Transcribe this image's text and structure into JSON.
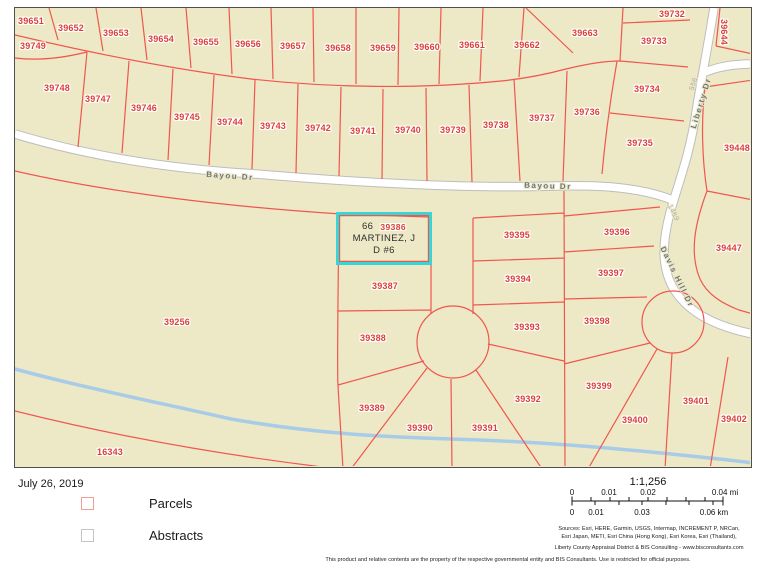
{
  "map": {
    "selected_parcel": {
      "account": "39386",
      "lines": [
        "66",
        "MARTINEZ, J",
        "D #6"
      ]
    },
    "parcel_labels": [
      {
        "t": "39651",
        "x": 31,
        "y": 21
      },
      {
        "t": "39652",
        "x": 71,
        "y": 28
      },
      {
        "t": "39653",
        "x": 116,
        "y": 33
      },
      {
        "t": "39654",
        "x": 161,
        "y": 39
      },
      {
        "t": "39655",
        "x": 206,
        "y": 42
      },
      {
        "t": "39656",
        "x": 248,
        "y": 44
      },
      {
        "t": "39657",
        "x": 293,
        "y": 46
      },
      {
        "t": "39658",
        "x": 338,
        "y": 48
      },
      {
        "t": "39659",
        "x": 383,
        "y": 48
      },
      {
        "t": "39660",
        "x": 427,
        "y": 47
      },
      {
        "t": "39661",
        "x": 472,
        "y": 45
      },
      {
        "t": "39662",
        "x": 527,
        "y": 45
      },
      {
        "t": "39663",
        "x": 585,
        "y": 33
      },
      {
        "t": "39732",
        "x": 672,
        "y": 14
      },
      {
        "t": "39733",
        "x": 654,
        "y": 41
      },
      {
        "t": "39644",
        "x": 724,
        "y": 32,
        "rot": 90
      },
      {
        "t": "39734",
        "x": 647,
        "y": 89
      },
      {
        "t": "39735",
        "x": 640,
        "y": 143
      },
      {
        "t": "39736",
        "x": 587,
        "y": 112
      },
      {
        "t": "39737",
        "x": 542,
        "y": 118
      },
      {
        "t": "39738",
        "x": 496,
        "y": 125
      },
      {
        "t": "39739",
        "x": 453,
        "y": 130
      },
      {
        "t": "39740",
        "x": 408,
        "y": 130
      },
      {
        "t": "39741",
        "x": 363,
        "y": 131
      },
      {
        "t": "39742",
        "x": 318,
        "y": 128
      },
      {
        "t": "39743",
        "x": 273,
        "y": 126
      },
      {
        "t": "39744",
        "x": 230,
        "y": 122
      },
      {
        "t": "39745",
        "x": 187,
        "y": 117
      },
      {
        "t": "39746",
        "x": 144,
        "y": 108
      },
      {
        "t": "39747",
        "x": 98,
        "y": 99
      },
      {
        "t": "39748",
        "x": 57,
        "y": 88
      },
      {
        "t": "39749",
        "x": 33,
        "y": 46
      },
      {
        "t": "39448",
        "x": 737,
        "y": 148
      },
      {
        "t": "39447",
        "x": 729,
        "y": 248
      },
      {
        "t": "39256",
        "x": 177,
        "y": 322
      },
      {
        "t": "16343",
        "x": 110,
        "y": 452
      },
      {
        "t": "39387",
        "x": 385,
        "y": 286
      },
      {
        "t": "39388",
        "x": 373,
        "y": 338
      },
      {
        "t": "39389",
        "x": 372,
        "y": 408
      },
      {
        "t": "39390",
        "x": 420,
        "y": 428
      },
      {
        "t": "39391",
        "x": 485,
        "y": 428
      },
      {
        "t": "39392",
        "x": 528,
        "y": 399
      },
      {
        "t": "39393",
        "x": 527,
        "y": 327
      },
      {
        "t": "39394",
        "x": 518,
        "y": 279
      },
      {
        "t": "39395",
        "x": 517,
        "y": 235
      },
      {
        "t": "39396",
        "x": 617,
        "y": 232
      },
      {
        "t": "39397",
        "x": 611,
        "y": 273
      },
      {
        "t": "39398",
        "x": 597,
        "y": 321
      },
      {
        "t": "39399",
        "x": 599,
        "y": 386
      },
      {
        "t": "39400",
        "x": 635,
        "y": 420
      },
      {
        "t": "39401",
        "x": 696,
        "y": 401
      },
      {
        "t": "39402",
        "x": 734,
        "y": 419
      }
    ],
    "road_labels": [
      {
        "t": "Bayou Dr",
        "x": 230,
        "y": 176,
        "rot": 4
      },
      {
        "t": "Bayou Dr",
        "x": 548,
        "y": 186,
        "rot": 2
      },
      {
        "t": "Liberty Dr",
        "x": 701,
        "y": 103,
        "rot": -73
      },
      {
        "t": "556",
        "x": 694,
        "y": 84,
        "rot": -73,
        "minor": true
      },
      {
        "t": "Davis Hill Dr",
        "x": 677,
        "y": 277,
        "rot": 64
      },
      {
        "t": "1469",
        "x": 673,
        "y": 213,
        "rot": 64,
        "minor": true
      }
    ]
  },
  "legend": {
    "date": "July 26, 2019",
    "items": [
      {
        "label": "Parcels"
      },
      {
        "label": "Abstracts"
      }
    ]
  },
  "scalebar": {
    "ratio": "1:1,256",
    "mi_labels": [
      "0",
      "0.01",
      "0.02",
      "0.04 mi"
    ],
    "km_labels": [
      "0",
      "0.01",
      "0.03",
      "0.06 km"
    ]
  },
  "credits": {
    "sources_line1": "Sources: Esri, HERE, Garmin, USGS, Intermap, INCREMENT P, NRCan,",
    "sources_line2": "Esri Japan, METI, Esri China (Hong Kong), Esri Korea, Esri (Thailand),",
    "attribution": "Liberty County Appraisal District & BIS Consulting - www.bisconsultants.com",
    "disclaimer": "This product and relative contents are the property of the respective governmental entity and BIS Consultants.  Use is restricted for official purposes."
  },
  "colors": {
    "land": "#EDE9C6",
    "parcel_line": "#F0564E",
    "parcel_label": "#DC3F38",
    "selected_outline": "#35D6D6",
    "water": "#A8CBE8",
    "road_fill": "#FFFFFF",
    "road_casing": "#BDBDBD",
    "road_label": "#6E7577",
    "map_border": "#4F4F4F"
  }
}
